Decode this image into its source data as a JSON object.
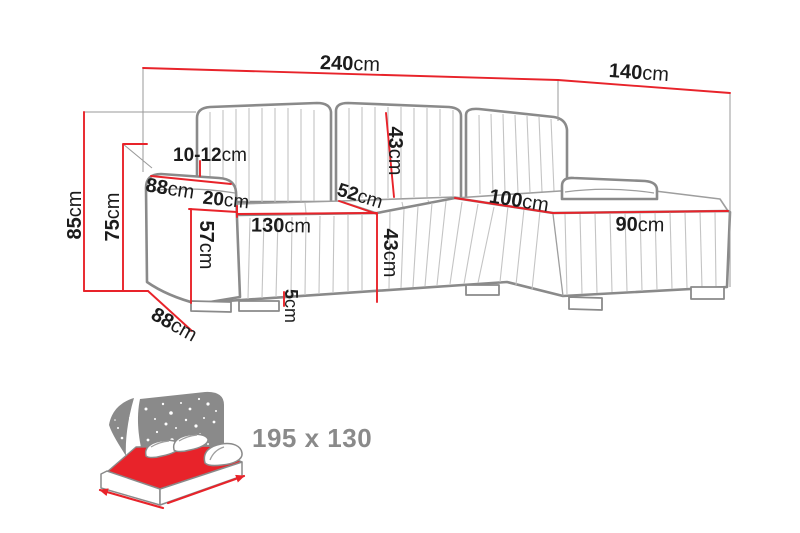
{
  "diagram": {
    "colors": {
      "dimension_red": "#e8232a",
      "outline_gray": "#8a8a8a",
      "channel_gray": "#c4c4c4",
      "icon_gray": "#8a8a8a",
      "label_black": "#1c1c1c"
    },
    "labels": {
      "total_width": {
        "value": "240",
        "unit": "cm"
      },
      "chaise_depth": {
        "value": "140",
        "unit": "cm"
      },
      "total_height": {
        "value": "85",
        "unit": "cm"
      },
      "armrest_height": {
        "value": "75",
        "unit": "cm"
      },
      "armrest_top_width": {
        "value": "10-12",
        "unit": "cm"
      },
      "top_depth": {
        "value": "88",
        "unit": "cm"
      },
      "front_edge": {
        "value": "20",
        "unit": "cm"
      },
      "seat_height": {
        "value": "57",
        "unit": "cm"
      },
      "seat_width": {
        "value": "130",
        "unit": "cm"
      },
      "corner_seat_width": {
        "value": "52",
        "unit": "cm"
      },
      "back_cushion_height": {
        "value": "43",
        "unit": "cm"
      },
      "front_height": {
        "value": "43",
        "unit": "cm"
      },
      "leg_height": {
        "value": "5",
        "unit": "cm"
      },
      "chaise_width": {
        "value": "100",
        "unit": "cm"
      },
      "chaise_length": {
        "value": "90",
        "unit": "cm"
      },
      "base_depth": {
        "value": "88",
        "unit": "cm"
      }
    },
    "sleeping_area": {
      "size_label": "195 x 130"
    }
  }
}
